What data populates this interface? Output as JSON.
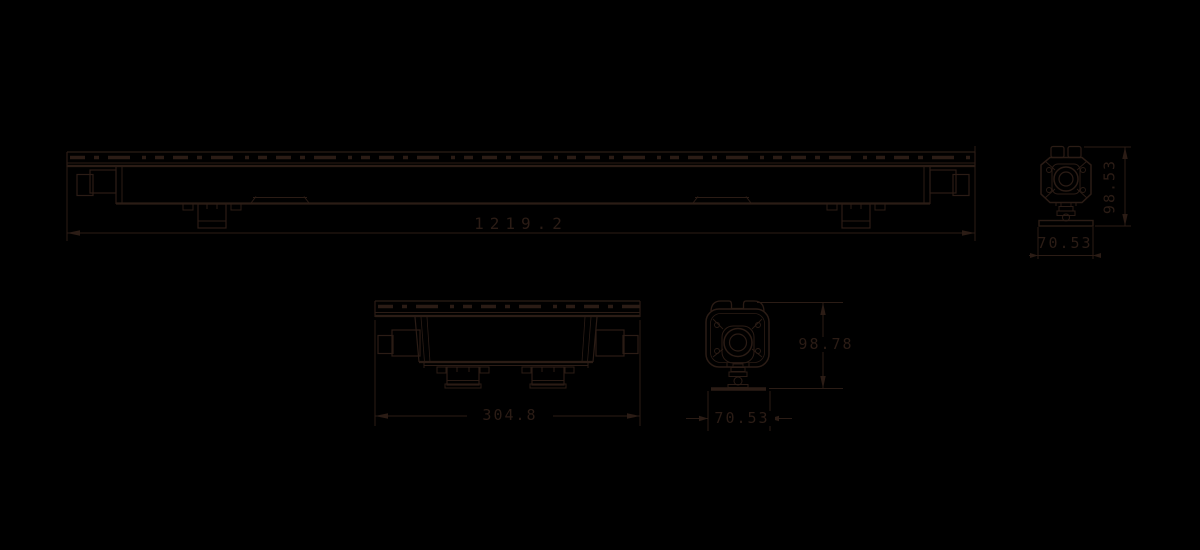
{
  "colors": {
    "background": "#000000",
    "ink": "#2b1c15"
  },
  "drawing": {
    "type": "mechanical-dimension-drawing",
    "views": {
      "long_bar_side": {
        "length_label": "1219.2"
      },
      "end_view_a": {
        "height_label": "98.53",
        "width_label": "70.53"
      },
      "short_bar_side": {
        "length_label": "304.8"
      },
      "end_view_b": {
        "height_label": "98.78",
        "width_label": "70.53"
      }
    }
  }
}
